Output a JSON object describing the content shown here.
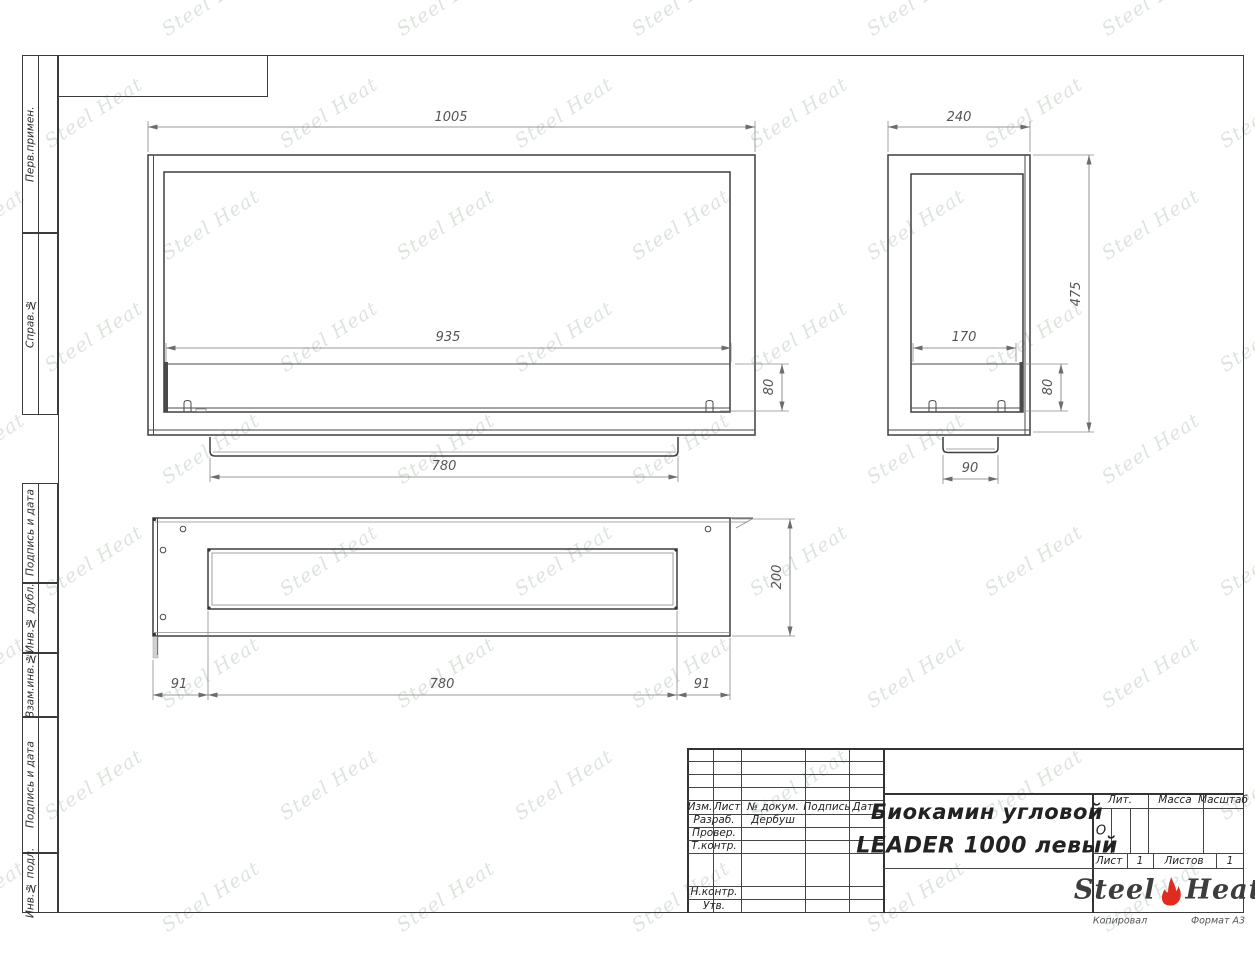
{
  "sheet": {
    "copy_note": "Копировал",
    "format_note": "Формат А3"
  },
  "sidebar": {
    "labels": [
      "Перв.примен.",
      "Справ.№",
      "Подпись и дата",
      "Инв.№ дубл.",
      "Взам.инв.№",
      "Подпись и дата",
      "Инв.№ подл."
    ]
  },
  "dims": {
    "front": {
      "width": "1005",
      "opening": "935",
      "burner_height": "80",
      "tray_width": "780"
    },
    "side": {
      "depth": "240",
      "height": "475",
      "opening_depth": "170",
      "burner_height": "80",
      "foot_width": "90"
    },
    "top": {
      "depth": "200",
      "margin_left": "91",
      "slot_width": "780",
      "margin_right": "91"
    }
  },
  "title_block": {
    "revision_columns": [
      "Изм.",
      "Лист",
      "№ докум.",
      "Подпись",
      "Дата"
    ],
    "roles": {
      "developer_label": "Разраб.",
      "developer_name": "Дербуш",
      "checker_label": "Провер.",
      "tcontrol_label": "Т.контр.",
      "ncontrol_label": "Н.контр.",
      "approver_label": "Утв."
    },
    "title_line1": "Биокамин угловой",
    "title_line2": "LEADER 1000 левый",
    "lit_label": "Лит.",
    "lit_value": "О",
    "mass_label": "Масса",
    "scale_label": "Масштаб",
    "sheet_label": "Лист",
    "sheet_value": "1",
    "sheets_label": "Листов",
    "sheets_value": "1"
  },
  "logo": {
    "steel": "Steel",
    "heat": "Heat"
  },
  "watermark": {
    "text": "Steel Heat"
  }
}
